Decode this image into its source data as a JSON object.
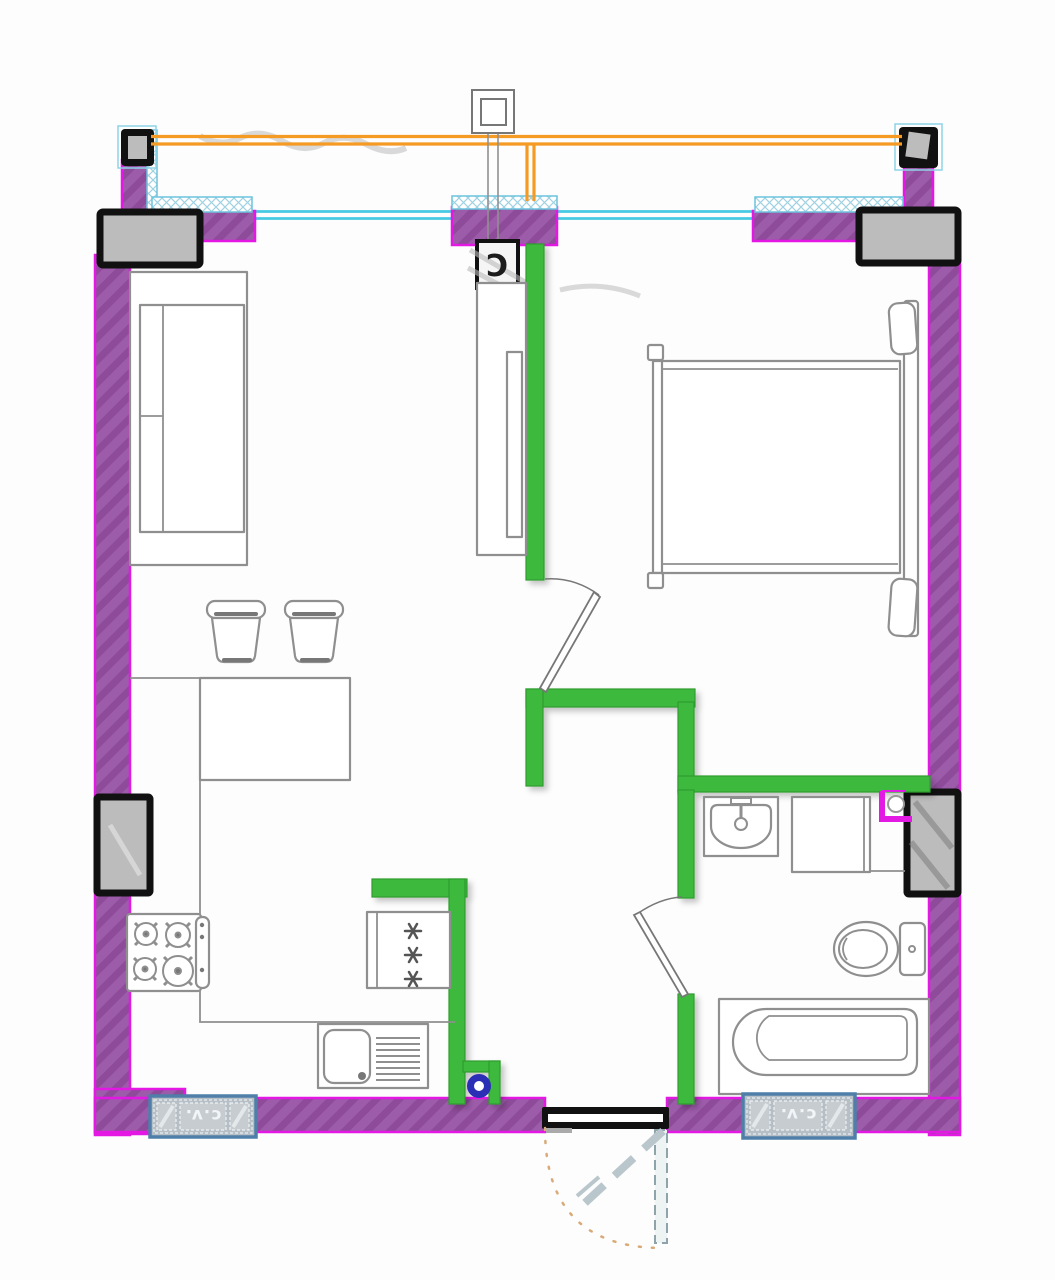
{
  "plan": {
    "type": "apartment-floor-plan",
    "labels": {
      "duct_marker": "C",
      "radiator_left": "c.v.",
      "radiator_right": "c.v."
    },
    "colors": {
      "exterior_wall": "#9d5caa",
      "wall_edge": "#e318e3",
      "partition_wall": "#3eba3e",
      "electrical_line": "#f59a23",
      "window_line": "#46c9e3",
      "window_hatch": "#9fd2e2",
      "column_fill": "#bcbcbc",
      "column_border": "#111111",
      "radiator_frame": "#4f7ea8",
      "floor_drain_blue": "#2b2fb5",
      "furniture_line": "#8f8f8f",
      "door_swing_dots": "#d9aa77",
      "pipe_magenta": "#e31ae3"
    },
    "fixtures": [
      "sofa",
      "stool",
      "stool",
      "dining-table",
      "kitchen-counter",
      "gas-stove",
      "kitchen-sink",
      "refrigerator-freezer",
      "wardrobe",
      "double-bed",
      "washbasin",
      "washing-machine",
      "toilet",
      "bathtub",
      "radiator-left",
      "radiator-right",
      "floor-drain",
      "entrance-door",
      "bedroom-door",
      "bathroom-door",
      "ceiling-junction-box",
      "ventilation-duct"
    ]
  }
}
